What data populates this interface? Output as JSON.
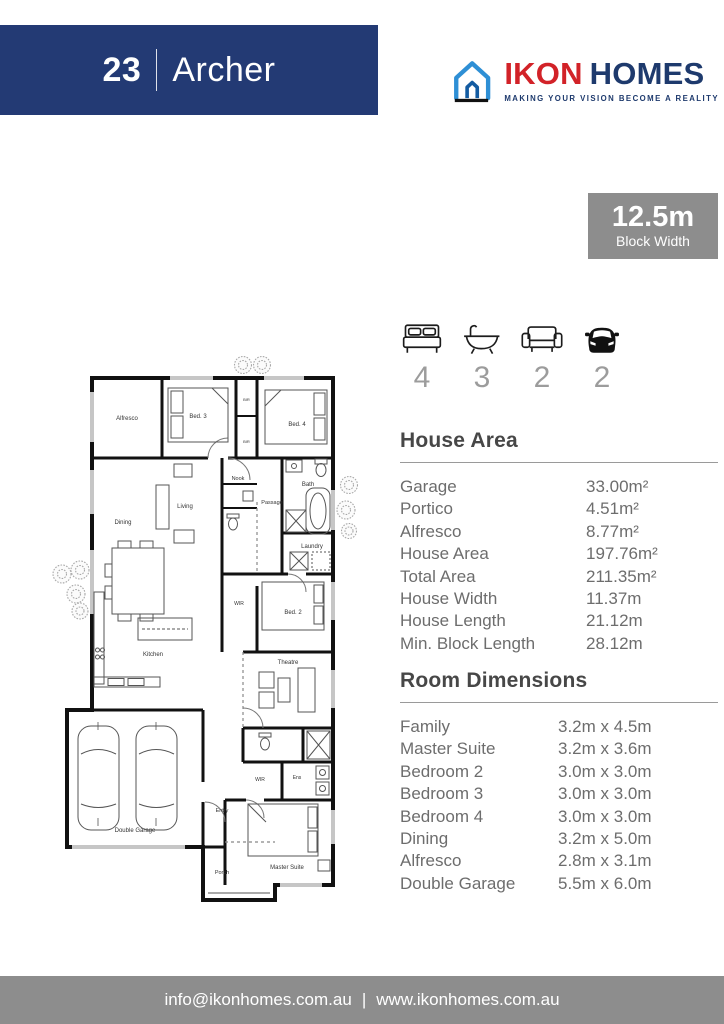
{
  "header": {
    "number": "23",
    "name": "Archer"
  },
  "logo": {
    "brand_first": "IKON",
    "brand_second": "HOMES",
    "tagline": "MAKING YOUR VISION BECOME A REALITY",
    "colors": {
      "red": "#d22228",
      "navy": "#1e3a6d",
      "blue": "#2e8fd5",
      "dark_blue": "#135ba1"
    }
  },
  "badge": {
    "value": "12.5m",
    "label": "Block Width"
  },
  "stats": {
    "bedrooms": "4",
    "bathrooms": "3",
    "living": "2",
    "garage": "2"
  },
  "house_area": {
    "title": "House Area",
    "items": [
      {
        "label": "Garage",
        "value": "33.00m²"
      },
      {
        "label": "Portico",
        "value": "4.51m²"
      },
      {
        "label": "Alfresco",
        "value": "8.77m²"
      },
      {
        "label": "House Area",
        "value": "197.76m²"
      },
      {
        "label": "Total Area",
        "value": "211.35m²"
      },
      {
        "label": "House Width",
        "value": "11.37m"
      },
      {
        "label": "House Length",
        "value": "21.12m"
      },
      {
        "label": "Min. Block Length",
        "value": "28.12m"
      }
    ]
  },
  "room_dimensions": {
    "title": "Room Dimensions",
    "items": [
      {
        "label": "Family",
        "value": "3.2m x 4.5m"
      },
      {
        "label": "Master Suite",
        "value": "3.2m x 3.6m"
      },
      {
        "label": "Bedroom 2",
        "value": "3.0m x 3.0m"
      },
      {
        "label": "Bedroom 3",
        "value": "3.0m x 3.0m"
      },
      {
        "label": "Bedroom 4",
        "value": "3.0m x 3.0m"
      },
      {
        "label": "Dining",
        "value": "3.2m x 5.0m"
      },
      {
        "label": "Alfresco",
        "value": "2.8m x 3.1m"
      },
      {
        "label": "Double Garage",
        "value": "5.5m x 6.0m"
      }
    ]
  },
  "floor_plan": {
    "rooms": {
      "alfresco": "Alfresco",
      "bed3": "Bed. 3",
      "bir1": "BIR",
      "bir2": "BIR",
      "bed4": "Bed. 4",
      "bath": "Bath",
      "nook": "Nook",
      "passage": "Passage",
      "living": "Living",
      "dining": "Dining",
      "laundry": "Laundry",
      "wir1": "WIR",
      "bed2": "Bed. 2",
      "kitchen": "Kitchen",
      "theatre": "Theatre",
      "entry": "Entry",
      "wir2": "WIR",
      "ens": "Ens",
      "double_garage": "Double Garage",
      "master_suite": "Master Suite",
      "porch": "Porch"
    }
  },
  "footer": {
    "email": "info@ikonhomes.com.au",
    "separator": "|",
    "website": "www.ikonhomes.com.au"
  },
  "colors": {
    "banner_navy": "#233a74",
    "badge_gray": "#8d8d8d",
    "heading": "#474747",
    "body_text": "#6d6d6d"
  }
}
